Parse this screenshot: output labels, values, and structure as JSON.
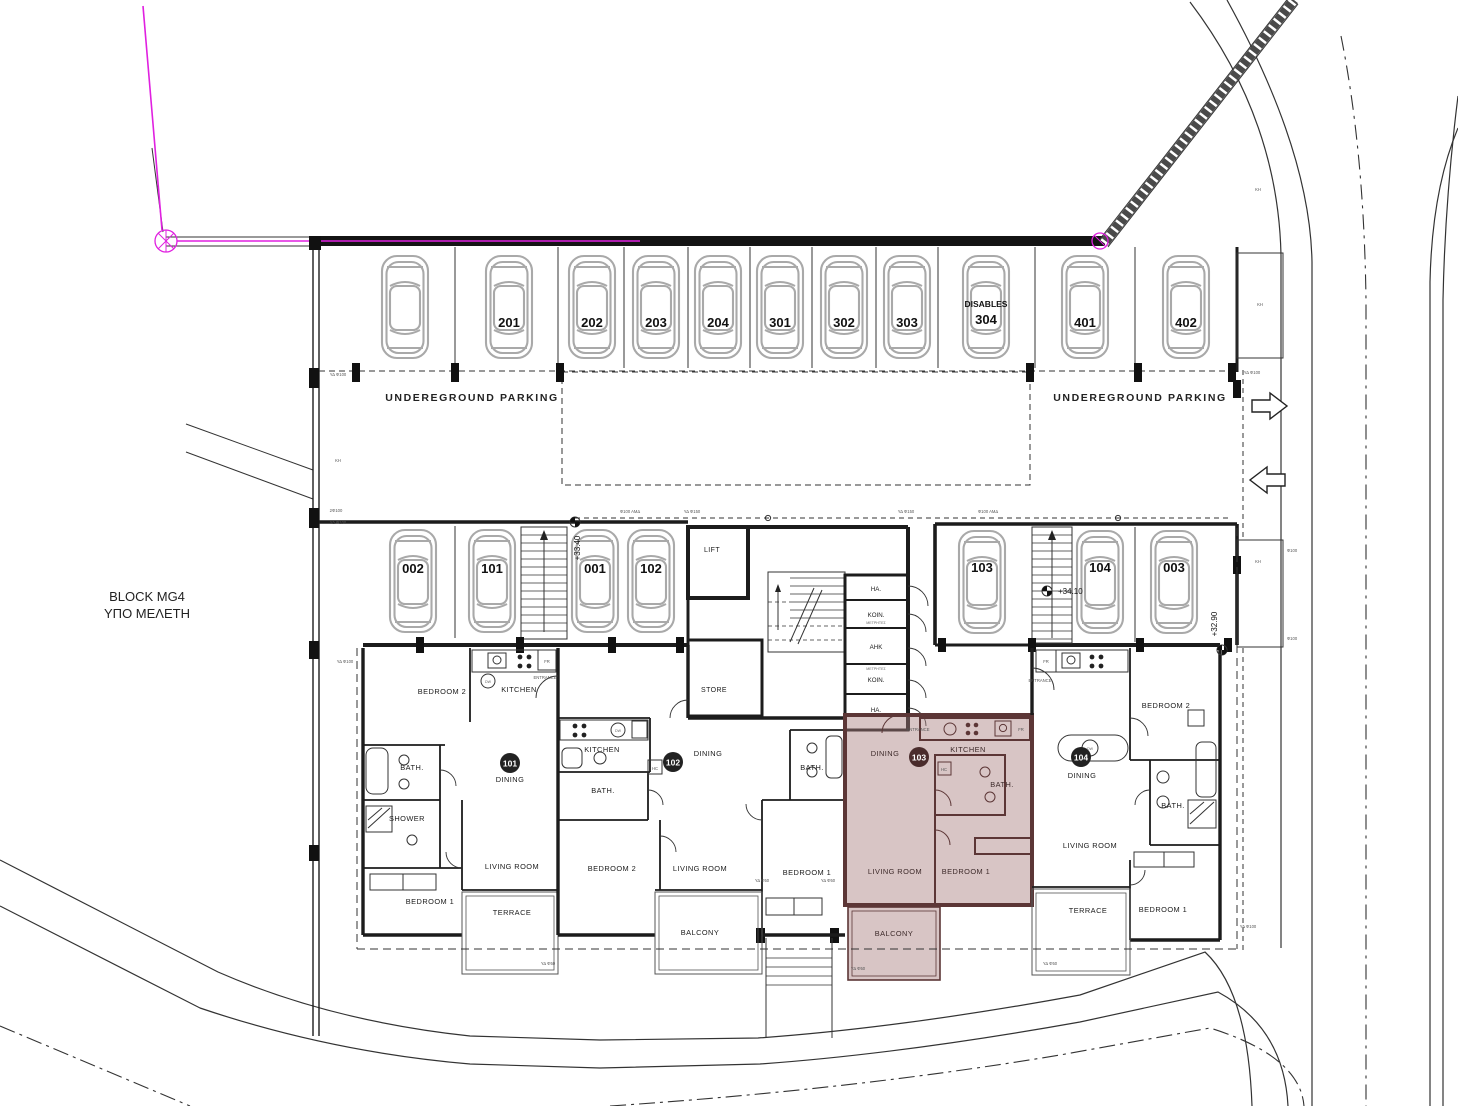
{
  "plan": {
    "block_name": "BLOCK MG4",
    "block_status": "ΥΠΟ ΜΕΛΕΤΗ"
  },
  "parking": {
    "area_label": "UNDEREGROUND PARKING",
    "disables": "DISABLES",
    "top_row": [
      "201",
      "202",
      "203",
      "204",
      "301",
      "302",
      "303",
      "304",
      "401",
      "402"
    ],
    "mid_row": [
      "002",
      "101",
      "001",
      "102"
    ],
    "right_row": [
      "103",
      "104",
      "003"
    ]
  },
  "core": {
    "lift": "LIFT",
    "store": "STORE",
    "cells": [
      "HA.",
      "KOIN.",
      "AHK",
      "KOIN.",
      "HA."
    ],
    "meters": "ΜΕΤΡΗΤΕΣ"
  },
  "units": {
    "u101": {
      "number": "101",
      "bedroom2": "BEDROOM 2",
      "kitchen": "KITCHEN",
      "bath": "BATH.",
      "shower": "SHOWER",
      "dining": "DINING",
      "living": "LIVING ROOM",
      "bedroom1": "BEDROOM 1",
      "terrace": "TERRACE"
    },
    "u102": {
      "number": "102",
      "kitchen": "KITCHEN",
      "bath": "BATH.",
      "bath2": "BATH.",
      "bedroom2": "BEDROOM 2",
      "dining": "DINING",
      "living": "LIVING ROOM",
      "bedroom1": "BEDROOM 1",
      "balcony": "BALCONY"
    },
    "u103": {
      "number": "103",
      "kitchen": "KITCHEN",
      "bath": "BATH.",
      "dining": "DINING",
      "living": "LIVING ROOM",
      "bedroom1": "BEDROOM 1",
      "balcony": "BALCONY"
    },
    "u104": {
      "number": "104",
      "bedroom2": "BEDROOM 2",
      "bath": "BATH.",
      "dining": "DINING",
      "living": "LIVING ROOM",
      "bedroom1": "BEDROOM 1",
      "terrace": "TERRACE"
    }
  },
  "levels": {
    "right_stair": "+34.10",
    "right_edge": "+32.90",
    "mid_stair": "+33.40"
  },
  "annotations": {
    "kh": "ΚΗ",
    "fr": "FR",
    "hc": "HC",
    "dw": "DW",
    "entrance": "ENTRANCE",
    "pipe_amd": "Φ100 ΑΜΔ",
    "pipe_yd150": "ΥΔ Φ150",
    "yd100": "ΥΔ Φ100",
    "yd50": "ΥΔ Φ50",
    "x2f100": "2Φ100",
    "f100": "Φ100"
  },
  "colors": {
    "highlight_fill": "#a97e7e",
    "highlight_wall": "#5c3636",
    "wall": "#1c1c1c",
    "car_outline": "#a9a9a9",
    "boundary_magenta": "#e020e0"
  }
}
